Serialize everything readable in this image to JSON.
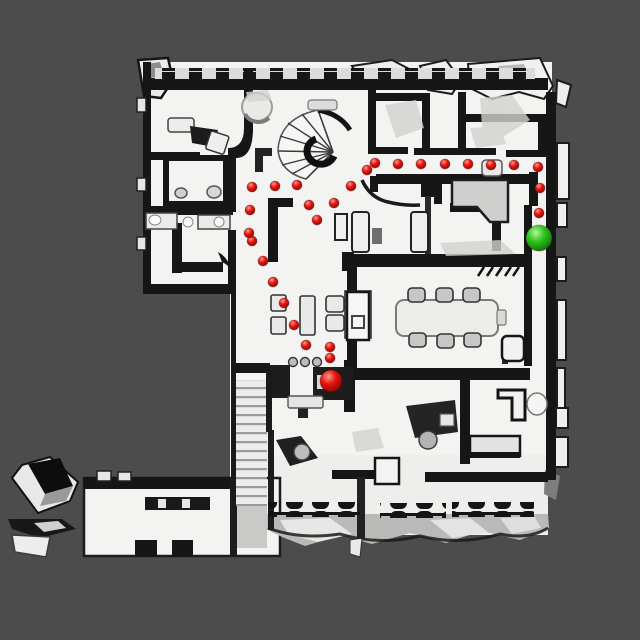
{
  "scene": {
    "kind": "top-down-3d-scan-floorplan",
    "background_color": "#4c4c4c",
    "floor_color": "#f3f3f1",
    "wall_color": "#161616"
  },
  "markers": {
    "waypoint_color": "#e01310",
    "goal_color": "#2ec51c",
    "waypoint_radius": 5,
    "waypoints": [
      {
        "x": 330,
        "y": 358
      },
      {
        "x": 330,
        "y": 347
      },
      {
        "x": 306,
        "y": 345
      },
      {
        "x": 294,
        "y": 325
      },
      {
        "x": 284,
        "y": 303
      },
      {
        "x": 273,
        "y": 282
      },
      {
        "x": 263,
        "y": 261
      },
      {
        "x": 252,
        "y": 241
      },
      {
        "x": 249,
        "y": 233
      },
      {
        "x": 250,
        "y": 210
      },
      {
        "x": 252,
        "y": 187
      },
      {
        "x": 275,
        "y": 186
      },
      {
        "x": 297,
        "y": 185
      },
      {
        "x": 309,
        "y": 205
      },
      {
        "x": 317,
        "y": 220
      },
      {
        "x": 334,
        "y": 203
      },
      {
        "x": 351,
        "y": 186
      },
      {
        "x": 367,
        "y": 170
      },
      {
        "x": 375,
        "y": 163
      },
      {
        "x": 398,
        "y": 164
      },
      {
        "x": 421,
        "y": 164
      },
      {
        "x": 445,
        "y": 164
      },
      {
        "x": 468,
        "y": 164
      },
      {
        "x": 491,
        "y": 165
      },
      {
        "x": 514,
        "y": 165
      },
      {
        "x": 538,
        "y": 167
      },
      {
        "x": 540,
        "y": 188
      },
      {
        "x": 539,
        "y": 213
      }
    ],
    "agent": {
      "x": 331,
      "y": 381,
      "r": 11
    },
    "goal": {
      "x": 539,
      "y": 238,
      "r": 13
    }
  }
}
